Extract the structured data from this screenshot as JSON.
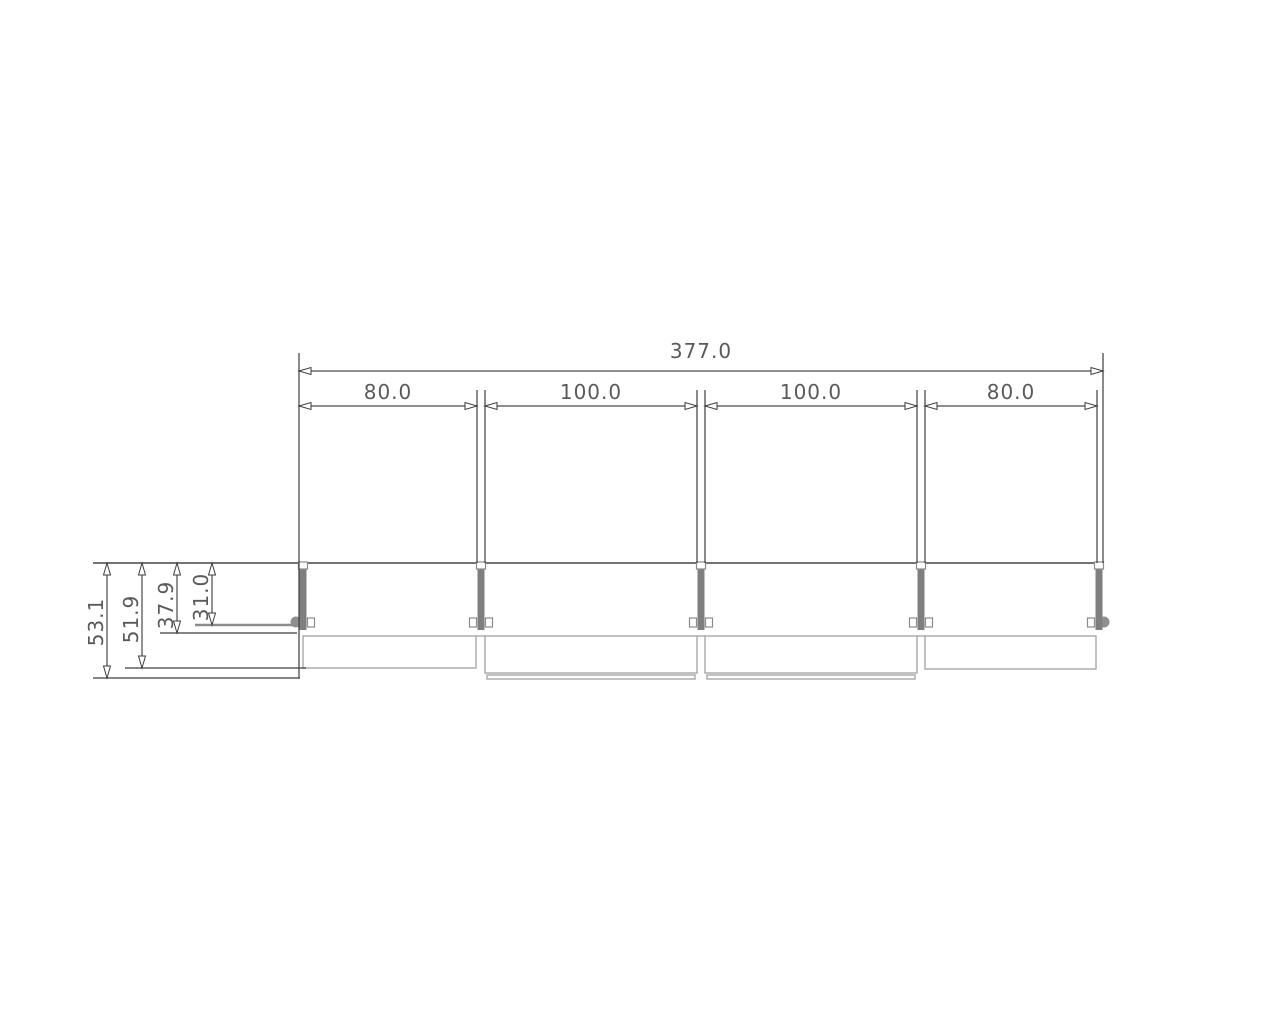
{
  "drawing": {
    "kind": "technical-dimension-drawing",
    "dimensions_horizontal": {
      "overall": "377.0",
      "bays": [
        "80.0",
        "100.0",
        "100.0",
        "80.0"
      ]
    },
    "dimensions_vertical": [
      "53.1",
      "51.9",
      "37.9",
      "31.0"
    ],
    "colors": {
      "background": "#ffffff",
      "dimension_lines": "#3d3d3d",
      "dimension_text": "#5a5a5a",
      "structure_line": "#5f5f5f",
      "post_fill": "#7f7f7f",
      "fitting_outline": "#8c8c8c",
      "glass_outline": "#a8a8a8"
    }
  }
}
